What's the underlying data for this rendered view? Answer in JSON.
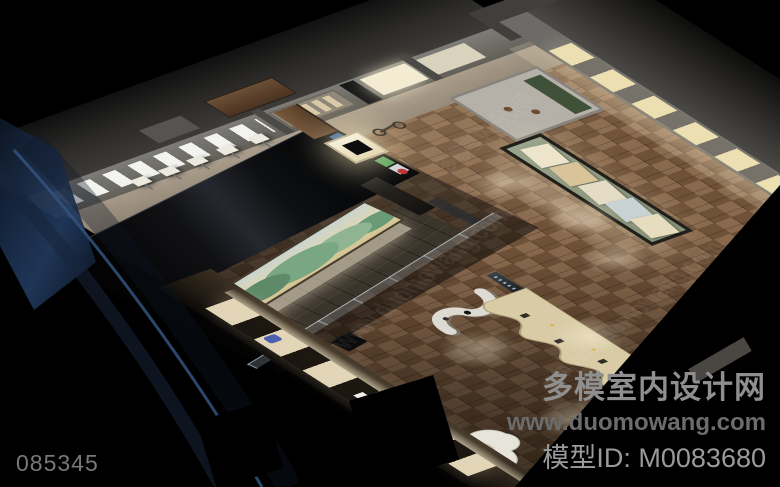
{
  "watermark": {
    "site_name": "多模室内设计网",
    "site_url": "www.duomowang.com",
    "model_id": "模型ID: M0083680",
    "image_code": "085345"
  },
  "palette": {
    "bg": "#000000",
    "floor_a": "#8a6a4e",
    "floor_b": "#6f5138",
    "wall": "#787878",
    "glow": "#ecdfb2",
    "mural_green": "#5e8a6a",
    "mural_cream": "#e2d8ae",
    "screen_blue": "#4f86c2",
    "screen_red": "#c24a38",
    "glass_blue": "#33527e",
    "counter_sand": "#d8cba6"
  }
}
